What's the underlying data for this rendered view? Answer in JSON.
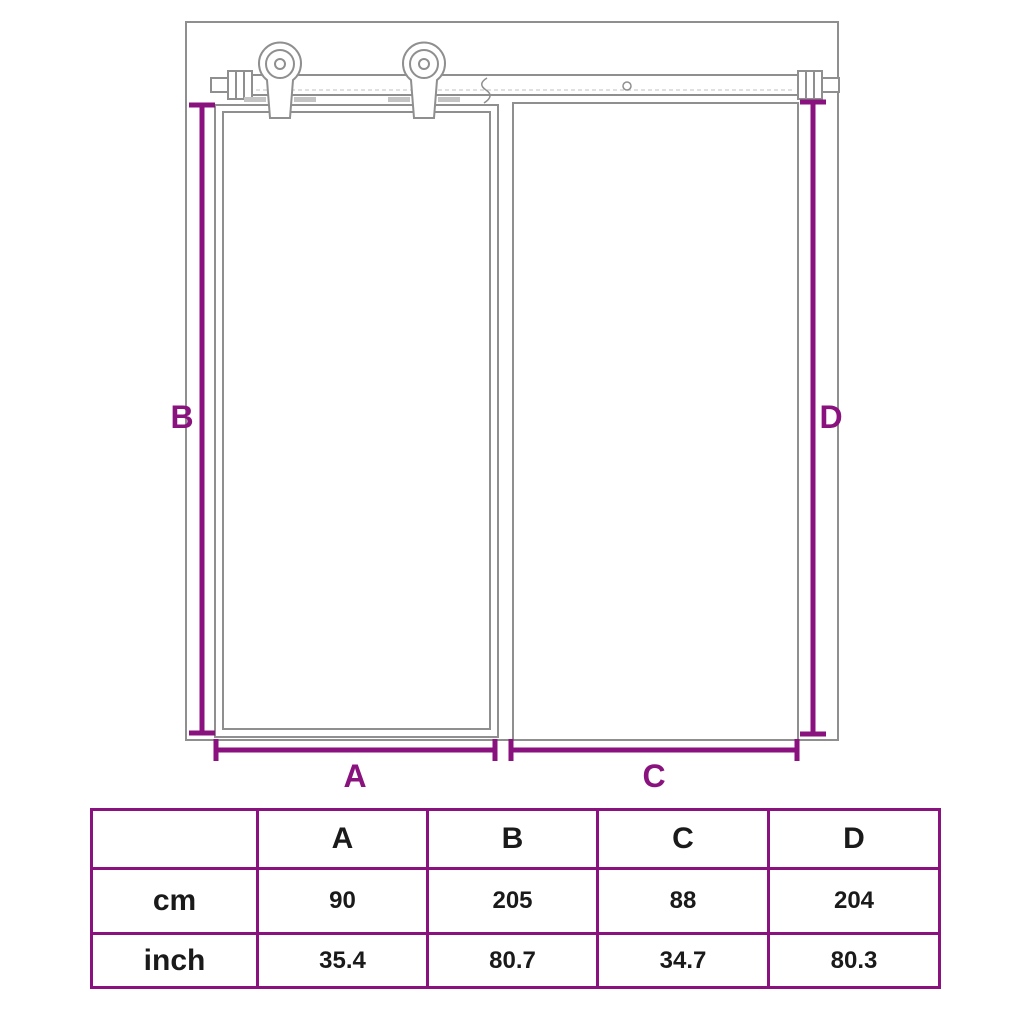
{
  "diagram": {
    "labels": {
      "a": "A",
      "b": "B",
      "c": "C",
      "d": "D"
    }
  },
  "table": {
    "headers": [
      "",
      "A",
      "B",
      "C",
      "D"
    ],
    "rows": [
      {
        "label": "cm",
        "values": [
          "90",
          "205",
          "88",
          "204"
        ]
      },
      {
        "label": "inch",
        "values": [
          "35.4",
          "80.7",
          "34.7",
          "80.3"
        ]
      }
    ]
  },
  "colors": {
    "accent": "#8A127F",
    "diagram-line": "#8F8F8F",
    "text": "#1A1A1A"
  }
}
